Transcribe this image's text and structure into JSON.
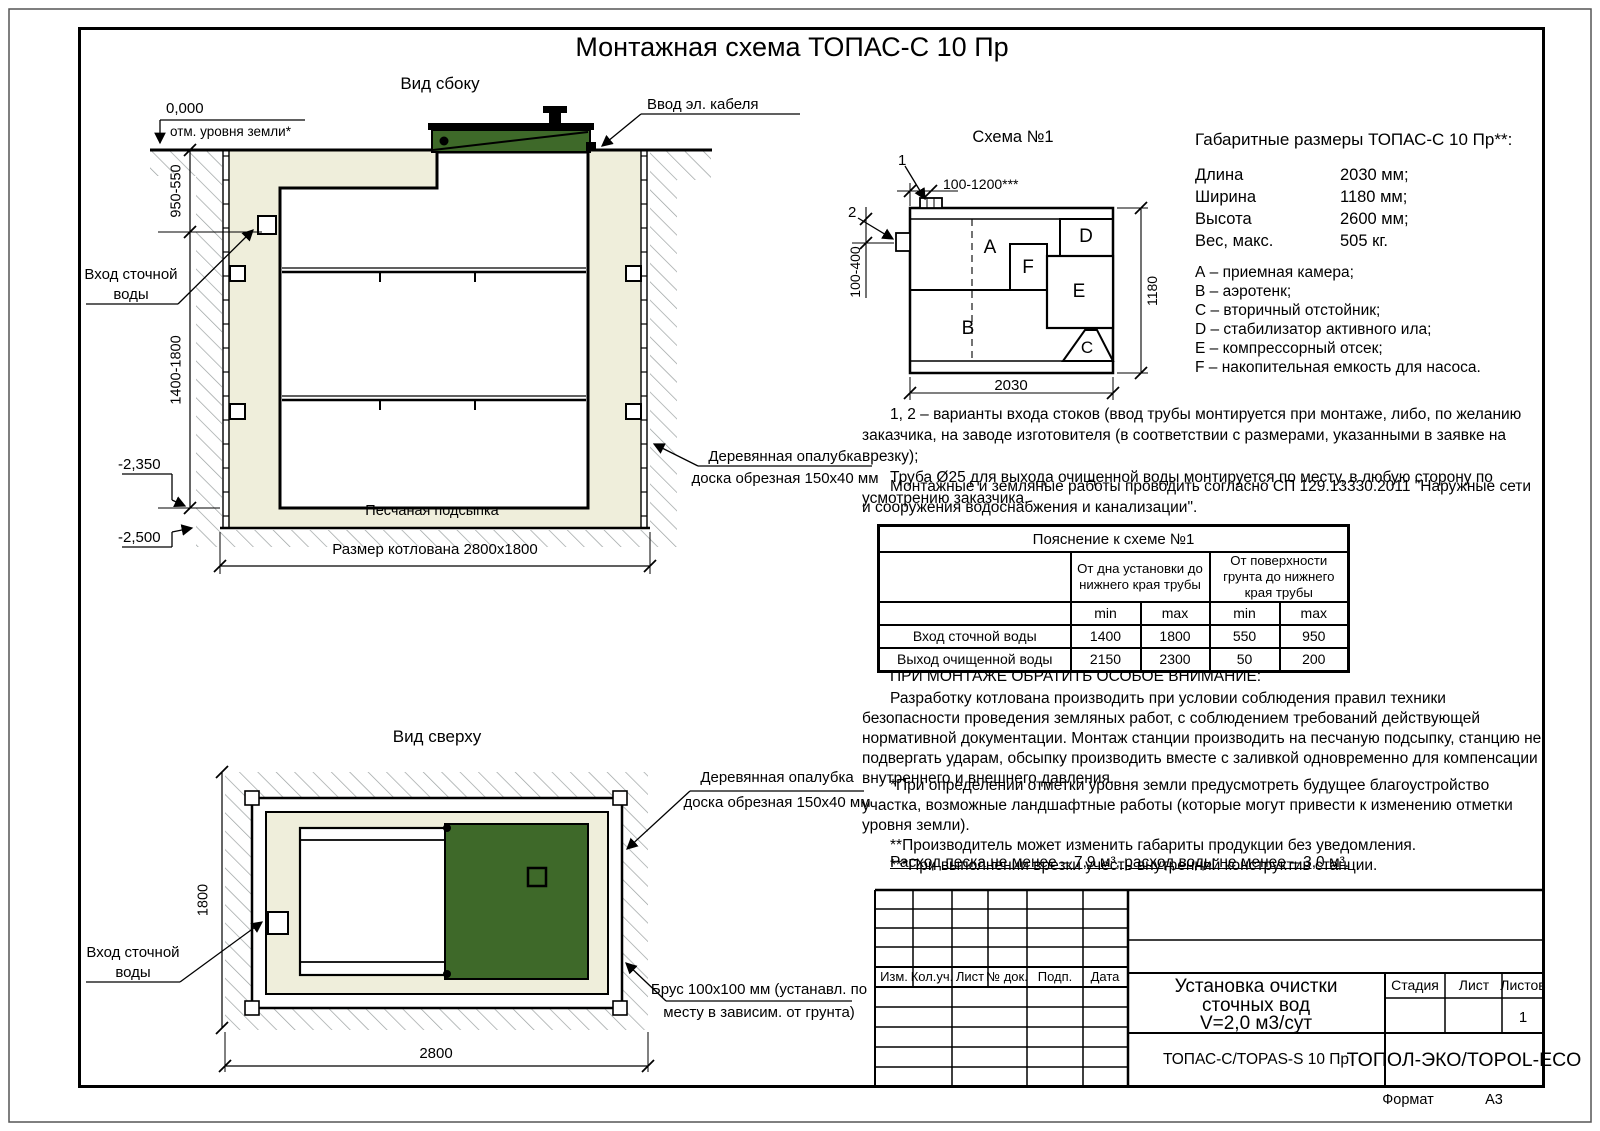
{
  "page": {
    "title": "Монтажная схема ТОПАС-С 10 Пр",
    "format_label": "Формат",
    "format_value": "А3"
  },
  "side_view": {
    "title": "Вид сбоку",
    "zero_mark": "0,000",
    "ground_note": "отм. уровня земли*",
    "cable_note": "Ввод эл. кабеля",
    "inlet_line1": "Вход сточной",
    "inlet_line2": "воды",
    "dim_upper": "950-550",
    "dim_lower": "1400-1800",
    "level_1": "-2,350",
    "level_2": "-2,500",
    "sand_note": "Песчаная подсыпка",
    "pit_note": "Размер котлована 2800x1800",
    "formwork_line1": "Деревянная опалубка",
    "formwork_line2": "доска обрезная 150x40 мм"
  },
  "top_view": {
    "title": "Вид сверху",
    "formwork_line1": "Деревянная опалубка",
    "formwork_line2": "доска обрезная 150x40 мм",
    "inlet_line1": "Вход сточной",
    "inlet_line2": "воды",
    "dim_side": "1800",
    "dim_bottom": "2800",
    "timber_line1": "Брус 100x100 мм (устанавл. по",
    "timber_line2": "месту в зависим. от грунта)"
  },
  "schema": {
    "title": "Схема №1",
    "marker_1": "1",
    "marker_2": "2",
    "dim_top": "100-1200***",
    "dim_left": "100-400",
    "dim_right": "1180",
    "dim_bottom": "2030",
    "letters": {
      "a": "A",
      "b": "B",
      "c": "C",
      "d": "D",
      "e": "E",
      "f": "F"
    }
  },
  "specs": {
    "title": "Габаритные размеры ТОПАС-С 10 Пр**:",
    "rows": [
      {
        "label": "Длина",
        "value": "2030 мм;"
      },
      {
        "label": "Ширина",
        "value": "1180 мм;"
      },
      {
        "label": "Высота",
        "value": "2600 мм;"
      },
      {
        "label": "Вес, макс.",
        "value": "505 кг."
      }
    ],
    "legend": [
      "А – приемная камера;",
      "В – аэротенк;",
      "С – вторичный отстойник;",
      "D – стабилизатор активного ила;",
      "Е – компрессорный отсек;",
      "F – накопительная емкость для насоса."
    ]
  },
  "notes": {
    "variants_1": "1, 2 – варианты входа  стоков (ввод трубы монтируется при монтаже, либо, по желанию заказчика, на заводе изготовителя (в соответствии с размерами, указанными в заявке на врезку);",
    "variants_2": "Труба Ø25 для выхода очищенной воды монтируется по месту, в любую сторону по усмотрению заказчика.",
    "works": "Монтажные и земляные работы проводить согласно СП 129.13330.2011 \"Наружные сети и сооружения водоснабжения и канализации\".",
    "attention_title": "ПРИ МОНТАЖЕ ОБРАТИТЬ ОСОБОЕ ВНИМАНИЕ:",
    "attention_body": "Разработку котлована производить при условии соблюдения правил техники безопасности проведения земляных работ, с соблюдением требований действующей нормативной документации. Монтаж станции производить на песчаную подсыпку, станцию не подвергать ударам, обсыпку производить вместе с заливкой одновременно для компенсации внутреннего и внешнего давления.",
    "footnote_1": "*При определении отметки уровня земли предусмотреть будущее благоустройство участка, возможные ландшафтные работы (которые могут привести к изменению отметки уровня земли).",
    "footnote_2": "**Производитель может изменить габариты продукции без уведомления.",
    "footnote_3": "***При выполнении врезки учесть внутренний конструктив станции.",
    "consumption": "Расход песка не менее – 7,9 м³, расход воды не менее – 3,0 м³."
  },
  "pipe_table": {
    "title": "Пояснение к схеме №1",
    "group_1": "От дна установки до нижнего края трубы",
    "group_2": "От поверхности грунта до нижнего края трубы",
    "min_label": "min",
    "max_label": "max",
    "rows": [
      {
        "name": "Вход сточной воды",
        "v1": "1400",
        "v2": "1800",
        "v3": "550",
        "v4": "950"
      },
      {
        "name": "Выход очищенной воды",
        "v1": "2150",
        "v2": "2300",
        "v3": "50",
        "v4": "200"
      }
    ]
  },
  "title_block": {
    "cols": [
      "Изм.",
      "Кол.уч.",
      "Лист",
      "№ док.",
      "Подп.",
      "Дата"
    ],
    "doc_line1": "Установка очистки",
    "doc_line2": "сточных вод",
    "doc_line3": "V=2,0 м3/сут",
    "stage": "Стадия",
    "sheet": "Лист",
    "sheets": "Листов",
    "sheets_value": "1",
    "model": "ТОПАС-С/TOPAS-S 10 Пр",
    "company": "ТОПОЛ-ЭКО/TOPOL-ECO"
  },
  "colors": {
    "lid_green": "#3e6929",
    "sand": "#efeedb"
  }
}
